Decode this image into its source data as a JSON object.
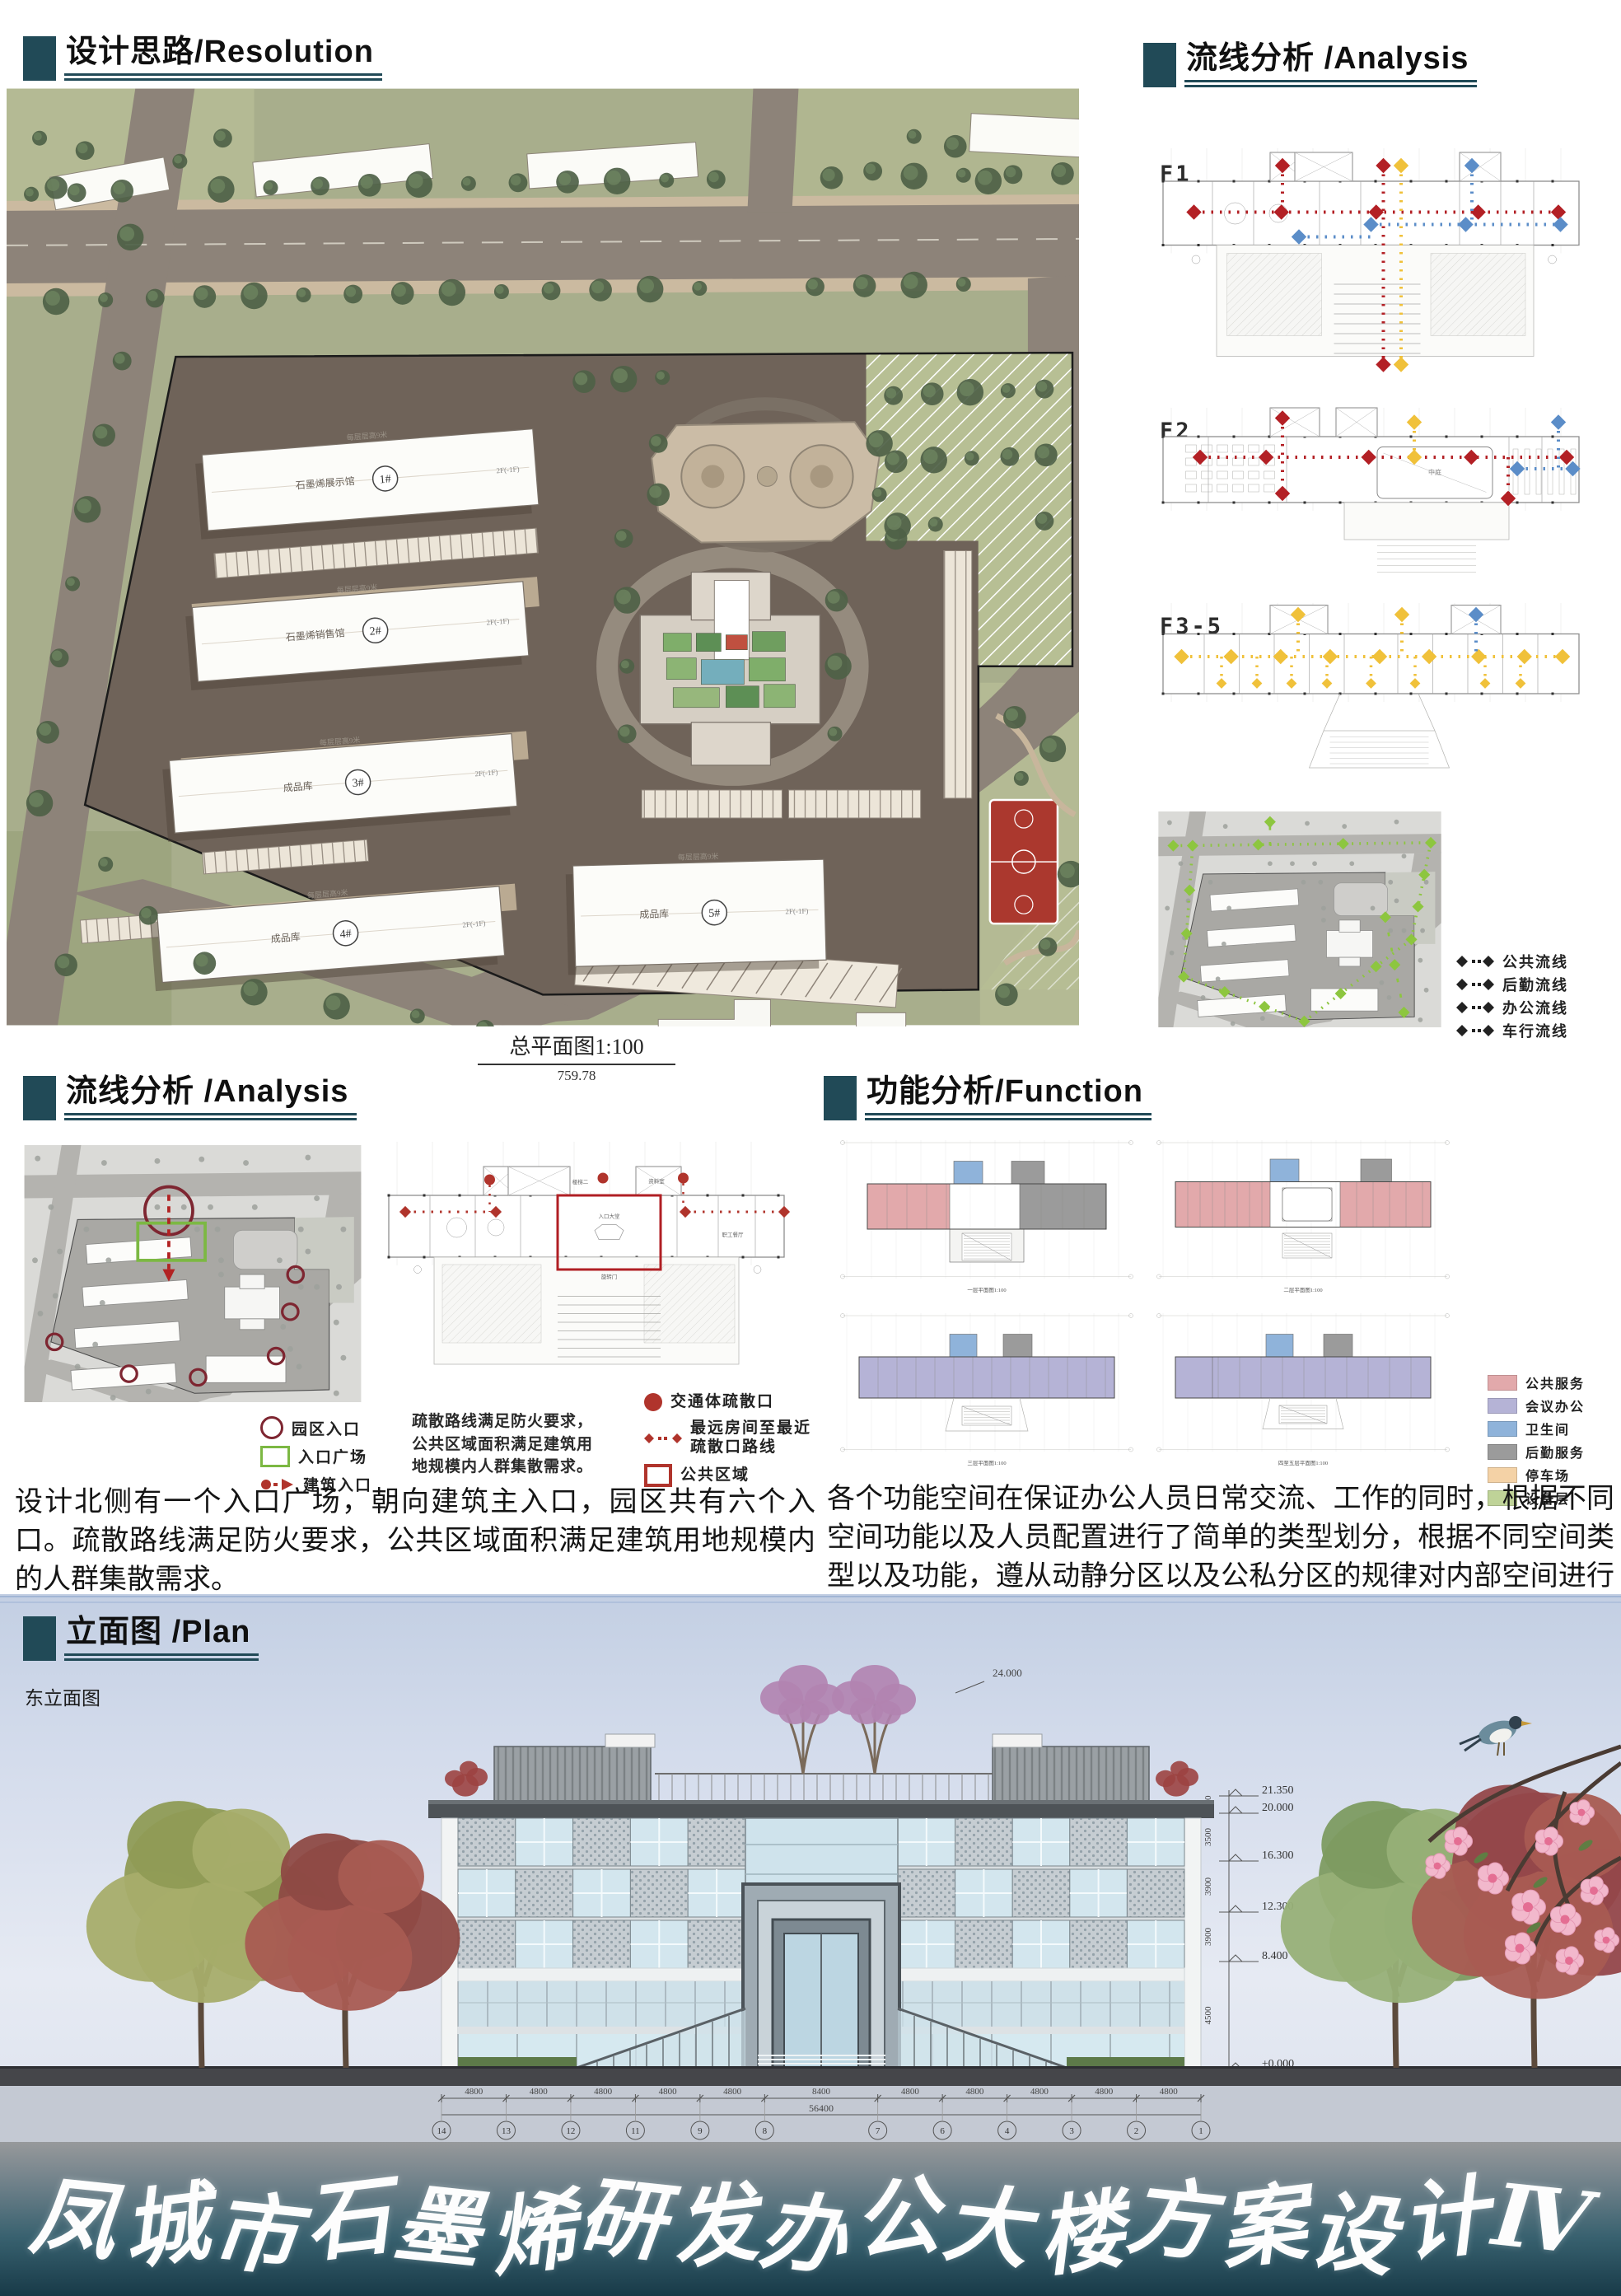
{
  "headers": {
    "resolution": {
      "zh": "设计思路",
      "en": "/Resolution"
    },
    "analysis_top": {
      "zh": "流线分析",
      "en": " /Analysis"
    },
    "analysis_mid": {
      "zh": "流线分析",
      "en": " /Analysis"
    },
    "function_h": {
      "zh": "功能分析",
      "en": "/Function"
    },
    "plan": {
      "zh": "立面图",
      "en": " /Plan"
    }
  },
  "site_plan": {
    "caption": "总平面图1:100",
    "caption_sub": "759.78",
    "buildings": [
      {
        "no": "1#",
        "name": "石墨烯展示馆",
        "floors": "2F(-1F)"
      },
      {
        "no": "2#",
        "name": "石墨烯销售馆",
        "floors": "2F(-1F)"
      },
      {
        "no": "3#",
        "name": "成品库",
        "floors": "2F(-1F)"
      },
      {
        "no": "4#",
        "name": "成品库",
        "floors": "2F(-1F)"
      },
      {
        "no": "5#",
        "name": "成品库",
        "floors": "2F(-1F)"
      }
    ],
    "side_note": "每层层高9米"
  },
  "circulation": {
    "floors": [
      "F1",
      "F2",
      "F3-5"
    ],
    "legend": [
      {
        "label": "公共流线",
        "color": "#b32025"
      },
      {
        "label": "后勤流线",
        "color": "#5b8dc8"
      },
      {
        "label": "办公流线",
        "color": "#f0c13a"
      },
      {
        "label": "车行流线",
        "color": "#8dc63f"
      }
    ]
  },
  "evacuation": {
    "site_legend": [
      {
        "label": "园区入口",
        "type": "circle"
      },
      {
        "label": "入口广场",
        "type": "rect"
      },
      {
        "label": "建筑入口",
        "type": "arrow"
      }
    ],
    "plan_legend": [
      {
        "label": "交通体疏散口",
        "type": "dot"
      },
      {
        "label": "最远房间至最近 疏散口路线",
        "type": "dash"
      },
      {
        "label": "公共区域",
        "type": "frame"
      }
    ],
    "note": "疏散路线满足防火要求，公共区域面积满足建筑用地规模内人群集散需求。",
    "rooms": [
      "入口大堂",
      "职工餐厅",
      "资料室",
      "楼梯二",
      "旋转门"
    ],
    "paragraph": "设计北侧有一个入口广场，朝向建筑主入口，园区共有六个入口。疏散路线满足防火要求，公共区域面积满足建筑用地规模内的人群集散需求。"
  },
  "function": {
    "legend": [
      {
        "label": "公共服务",
        "color": "#e2a9ab"
      },
      {
        "label": "会议办公",
        "color": "#b5b3d6"
      },
      {
        "label": "卫生间",
        "color": "#8fb3da"
      },
      {
        "label": "后勤服务",
        "color": "#9b9b9b"
      },
      {
        "label": "停车场",
        "color": "#f4d2a6"
      },
      {
        "label": "设备层",
        "color": "#bfd398"
      }
    ],
    "plan_captions": [
      "一层平面图1:100",
      "二层平面图1:100",
      "三层平面图1:100",
      "四至五层平面图1:100"
    ],
    "paragraph": "各个功能空间在保证办公人员日常交流、工作的同时，根据不同空间功能以及人员配置进行了简单的类型划分，根据不同空间类型以及功能，遵从动静分区以及公私分区的规律对内部空间进行了设计。"
  },
  "elevation": {
    "label": "东立面图",
    "roof_dim": "24.000",
    "levels": [
      "21.350",
      "20.000",
      "16.300",
      "12.300",
      "8.400",
      "±0.000",
      "-1.500"
    ],
    "floor_dims": [
      "1250",
      "3500",
      "3900",
      "3900",
      "4500",
      "1500"
    ],
    "total_height": "22750",
    "bay_dims": [
      "4800",
      "4800",
      "4800",
      "4800",
      "4800",
      "8400",
      "4800",
      "4800",
      "4800",
      "4800",
      "4800"
    ],
    "total_dim": "56400",
    "axes": [
      "14",
      "13",
      "12",
      "11",
      "9",
      "8",
      "7",
      "6",
      "4",
      "3",
      "2",
      "1"
    ]
  },
  "title": {
    "text": "凤城市石墨烯研发办公大楼方案设计Ⅳ"
  }
}
